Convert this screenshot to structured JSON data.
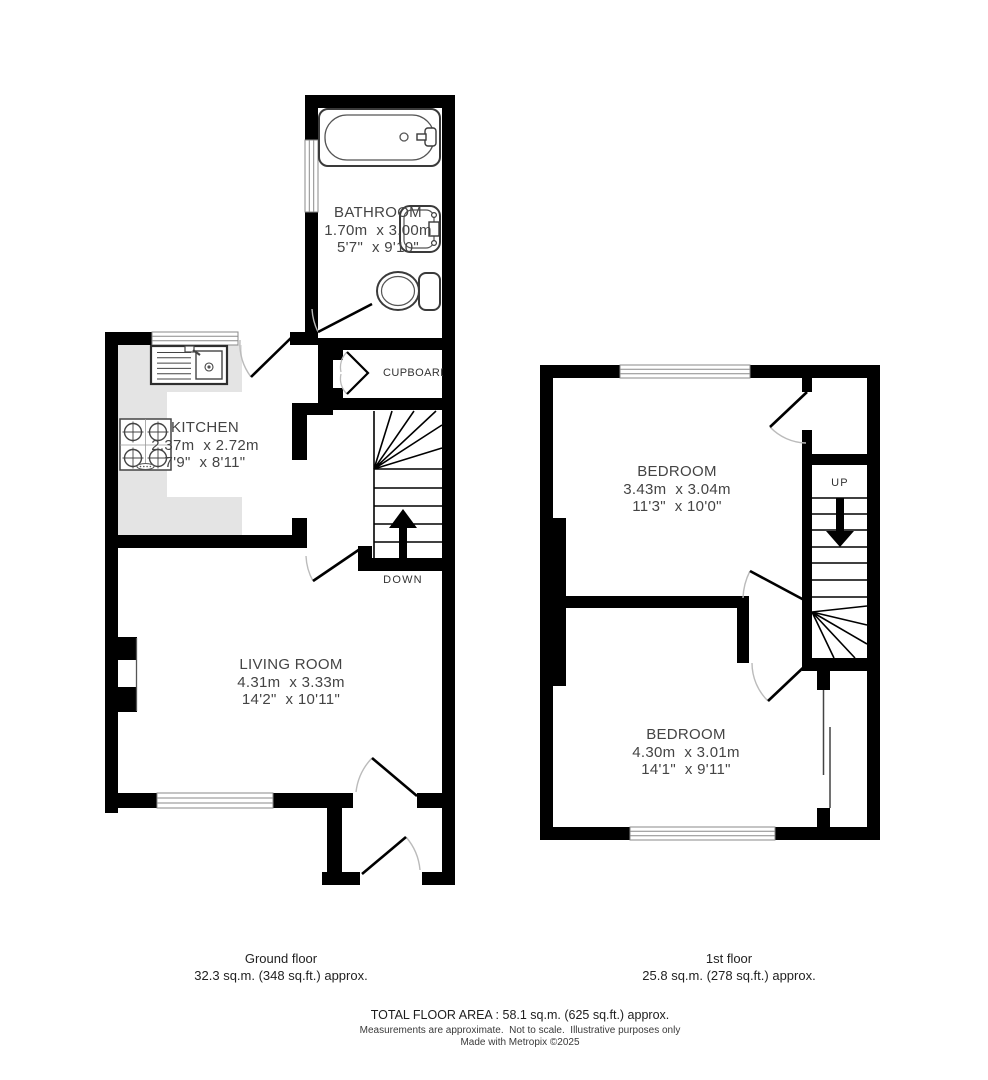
{
  "rooms": {
    "bathroom": {
      "name": "BATHROOM",
      "metric": "1.70m  x 3.00m",
      "imperial": "5'7\"  x 9'10\""
    },
    "kitchen": {
      "name": "KITCHEN",
      "metric": "2.37m  x 2.72m",
      "imperial": "7'9\"  x 8'11\""
    },
    "living_room": {
      "name": "LIVING ROOM",
      "metric": "4.31m  x 3.33m",
      "imperial": "14'2\"  x 10'11\""
    },
    "bedroom1": {
      "name": "BEDROOM",
      "metric": "3.43m  x 3.04m",
      "imperial": "11'3\"  x 10'0\""
    },
    "bedroom2": {
      "name": "BEDROOM",
      "metric": "4.30m  x 3.01m",
      "imperial": "14'1\"  x 9'11\""
    }
  },
  "features": {
    "cupboard_label": "CUPBOARD",
    "stairs_down_label": "DOWN",
    "stairs_up_label": "UP"
  },
  "fixtures": [
    "bathtub",
    "basin",
    "toilet",
    "kitchen-sink",
    "hob",
    "worktop"
  ],
  "footer": {
    "ground_floor_title": "Ground floor",
    "ground_floor_area": "32.3 sq.m. (348 sq.ft.) approx.",
    "first_floor_title": "1st floor",
    "first_floor_area": "25.8 sq.m. (278 sq.ft.) approx.",
    "total": "TOTAL FLOOR AREA : 58.1 sq.m. (625 sq.ft.) approx.",
    "disclaimer": "Measurements are approximate.  Not to scale.  Illustrative purposes only",
    "credit": "Made with Metropix ©2025"
  },
  "colors": {
    "wall": "#000000",
    "counter": "#e4e4e4",
    "window_line": "#8a8a8a",
    "door_arc": "#bbbbbb",
    "fixture_stroke": "#3a3a3a",
    "text": "#444444"
  }
}
